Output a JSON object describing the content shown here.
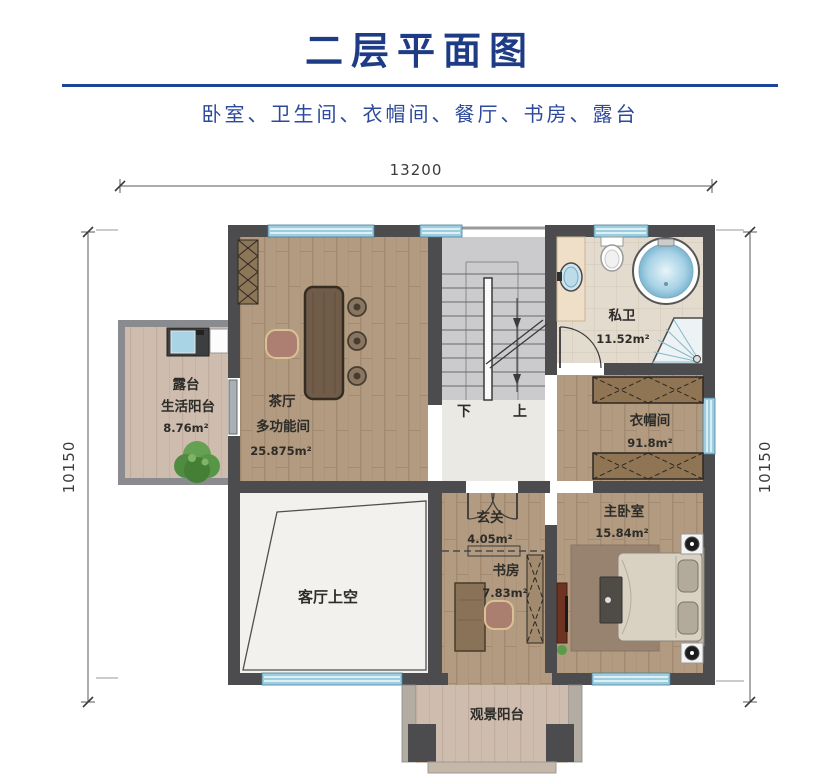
{
  "header": {
    "title": "二层平面图",
    "subtitle": "卧室、卫生间、衣帽间、餐厅、书房、露台"
  },
  "dimensions": {
    "top": "13200",
    "left": "10150",
    "right": "10150"
  },
  "stairs": {
    "down": "下",
    "up": "上"
  },
  "rooms": {
    "tea_room": {
      "name": "茶厅",
      "subname": "多功能间",
      "area": "25.875m²"
    },
    "private_bath": {
      "name": "私卫",
      "area": "11.52m²"
    },
    "cloakroom": {
      "name": "衣帽间",
      "area": "91.8m²"
    },
    "master_bedroom": {
      "name": "主卧室",
      "area": "15.84m²"
    },
    "foyer": {
      "name": "玄关",
      "area": "4.05m²"
    },
    "study": {
      "name": "书房",
      "area": "7.83m²"
    },
    "terrace": {
      "name": "露台",
      "subname": "生活阳台",
      "area": "8.76m²"
    },
    "living_void": {
      "name": "客厅上空"
    },
    "view_balcony": {
      "name": "观景阳台"
    }
  },
  "colors": {
    "title_blue": "#1e3c85",
    "divider_blue": "#1d4598",
    "subtitle_blue": "#2c4a9c",
    "wall": "#4c4c4e",
    "window_blue": "#9ccee0",
    "wood_floor": "#b29b80",
    "terrace_floor": "#cebdae",
    "tile_floor": "#e3dbce",
    "stair_floor": "#cbcbce",
    "marble": "#f2f1ee"
  }
}
